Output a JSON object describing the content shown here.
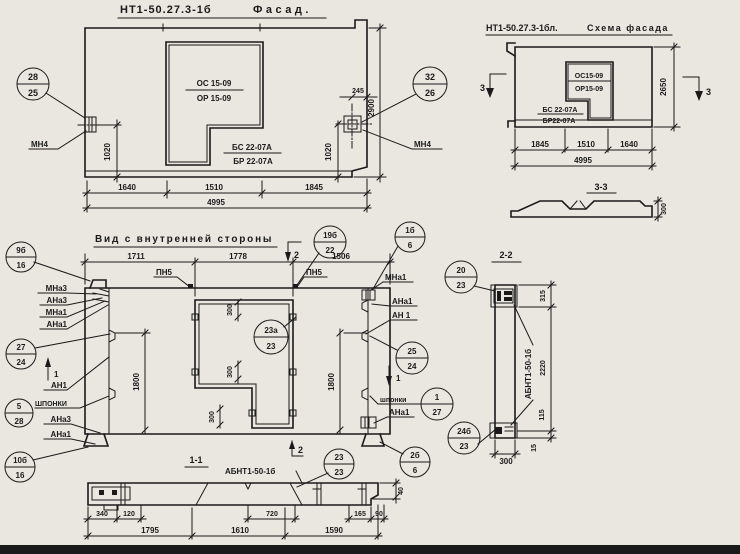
{
  "colors": {
    "paper": "#e9e7e0",
    "ink": "#1a1a1a"
  },
  "facade": {
    "title_code": "НТ1-50.27.3-1б",
    "title_word": "Фасад.",
    "win_top": "ОС 15-09",
    "win_bot": "ОР 15-09",
    "base_top": "БС 22-07А",
    "base_bot": "БР 22-07А",
    "callout_left": {
      "top": "28",
      "bot": "25"
    },
    "callout_right": {
      "top": "32",
      "bot": "26"
    },
    "embed_left": "МН4",
    "embed_right": "МН4",
    "dim_left_v": "1020",
    "dim_right_v": "1020",
    "dim_offset": "245",
    "dim_height": "2900",
    "dim_b1": "1640",
    "dim_b2": "1510",
    "dim_b3": "1845",
    "dim_total": "4995"
  },
  "scheme": {
    "title_code": "НТ1-50.27.3-1бл.",
    "title_word": "Схема фасада",
    "win_top": "ОС15-09",
    "win_bot": "ОР15-09",
    "base_top": "БС 22-07А",
    "base_bot": "БР22-07А",
    "sec_mark": "3",
    "dim_height": "2650",
    "dim_b1": "1845",
    "dim_b2": "1510",
    "dim_b3": "1640",
    "dim_total": "4995",
    "sec_title": "3-3",
    "sec_dim": "300"
  },
  "inner": {
    "title": "Вид с внутренней стороны",
    "dim_t1": "1711",
    "dim_t2": "1778",
    "dim_t3": "1506",
    "pn5": "ПН5",
    "sec2": "2",
    "sec1": "1",
    "dim_300": "300",
    "dim_1800": "1800",
    "lbl": {
      "mna3": "МНа3",
      "ana3": "АНа3",
      "mna1": "МНа1",
      "ana1": "АНа1",
      "an1": "АН1",
      "an1r": "АН 1",
      "shponki_caps": "ШПОНКИ",
      "shponki_low": "шпонки"
    },
    "callouts": {
      "c9b": {
        "top": "9б",
        "bot": "16"
      },
      "c19b": {
        "top": "19б",
        "bot": "22"
      },
      "c1b": {
        "top": "1б",
        "bot": "6"
      },
      "c27": {
        "top": "27",
        "bot": "24"
      },
      "c5": {
        "top": "5",
        "bot": "28"
      },
      "c10b": {
        "top": "10б",
        "bot": "16"
      },
      "c23a": {
        "top": "23а",
        "bot": "23"
      },
      "c25": {
        "top": "25",
        "bot": "24"
      },
      "c20": {
        "top": "20",
        "bot": "23"
      },
      "c1_27": {
        "top": "1",
        "bot": "27"
      },
      "c24b": {
        "top": "24б",
        "bot": "23"
      },
      "c2b": {
        "top": "2б",
        "bot": "6"
      },
      "c23": {
        "top": "23",
        "bot": "23"
      }
    }
  },
  "sec11": {
    "title": "1-1",
    "label": "АБНТ1-50-1б",
    "d340": "340",
    "d120": "120",
    "d720": "720",
    "d165": "165",
    "d90": "90",
    "d1795": "1795",
    "d1610": "1610",
    "d1590": "1590",
    "d40": "40"
  },
  "sec22": {
    "title": "2-2",
    "label": "АБНТ1-50-1б",
    "d315": "315",
    "d2220": "2220",
    "d115": "115",
    "d15": "15",
    "d300": "300"
  }
}
